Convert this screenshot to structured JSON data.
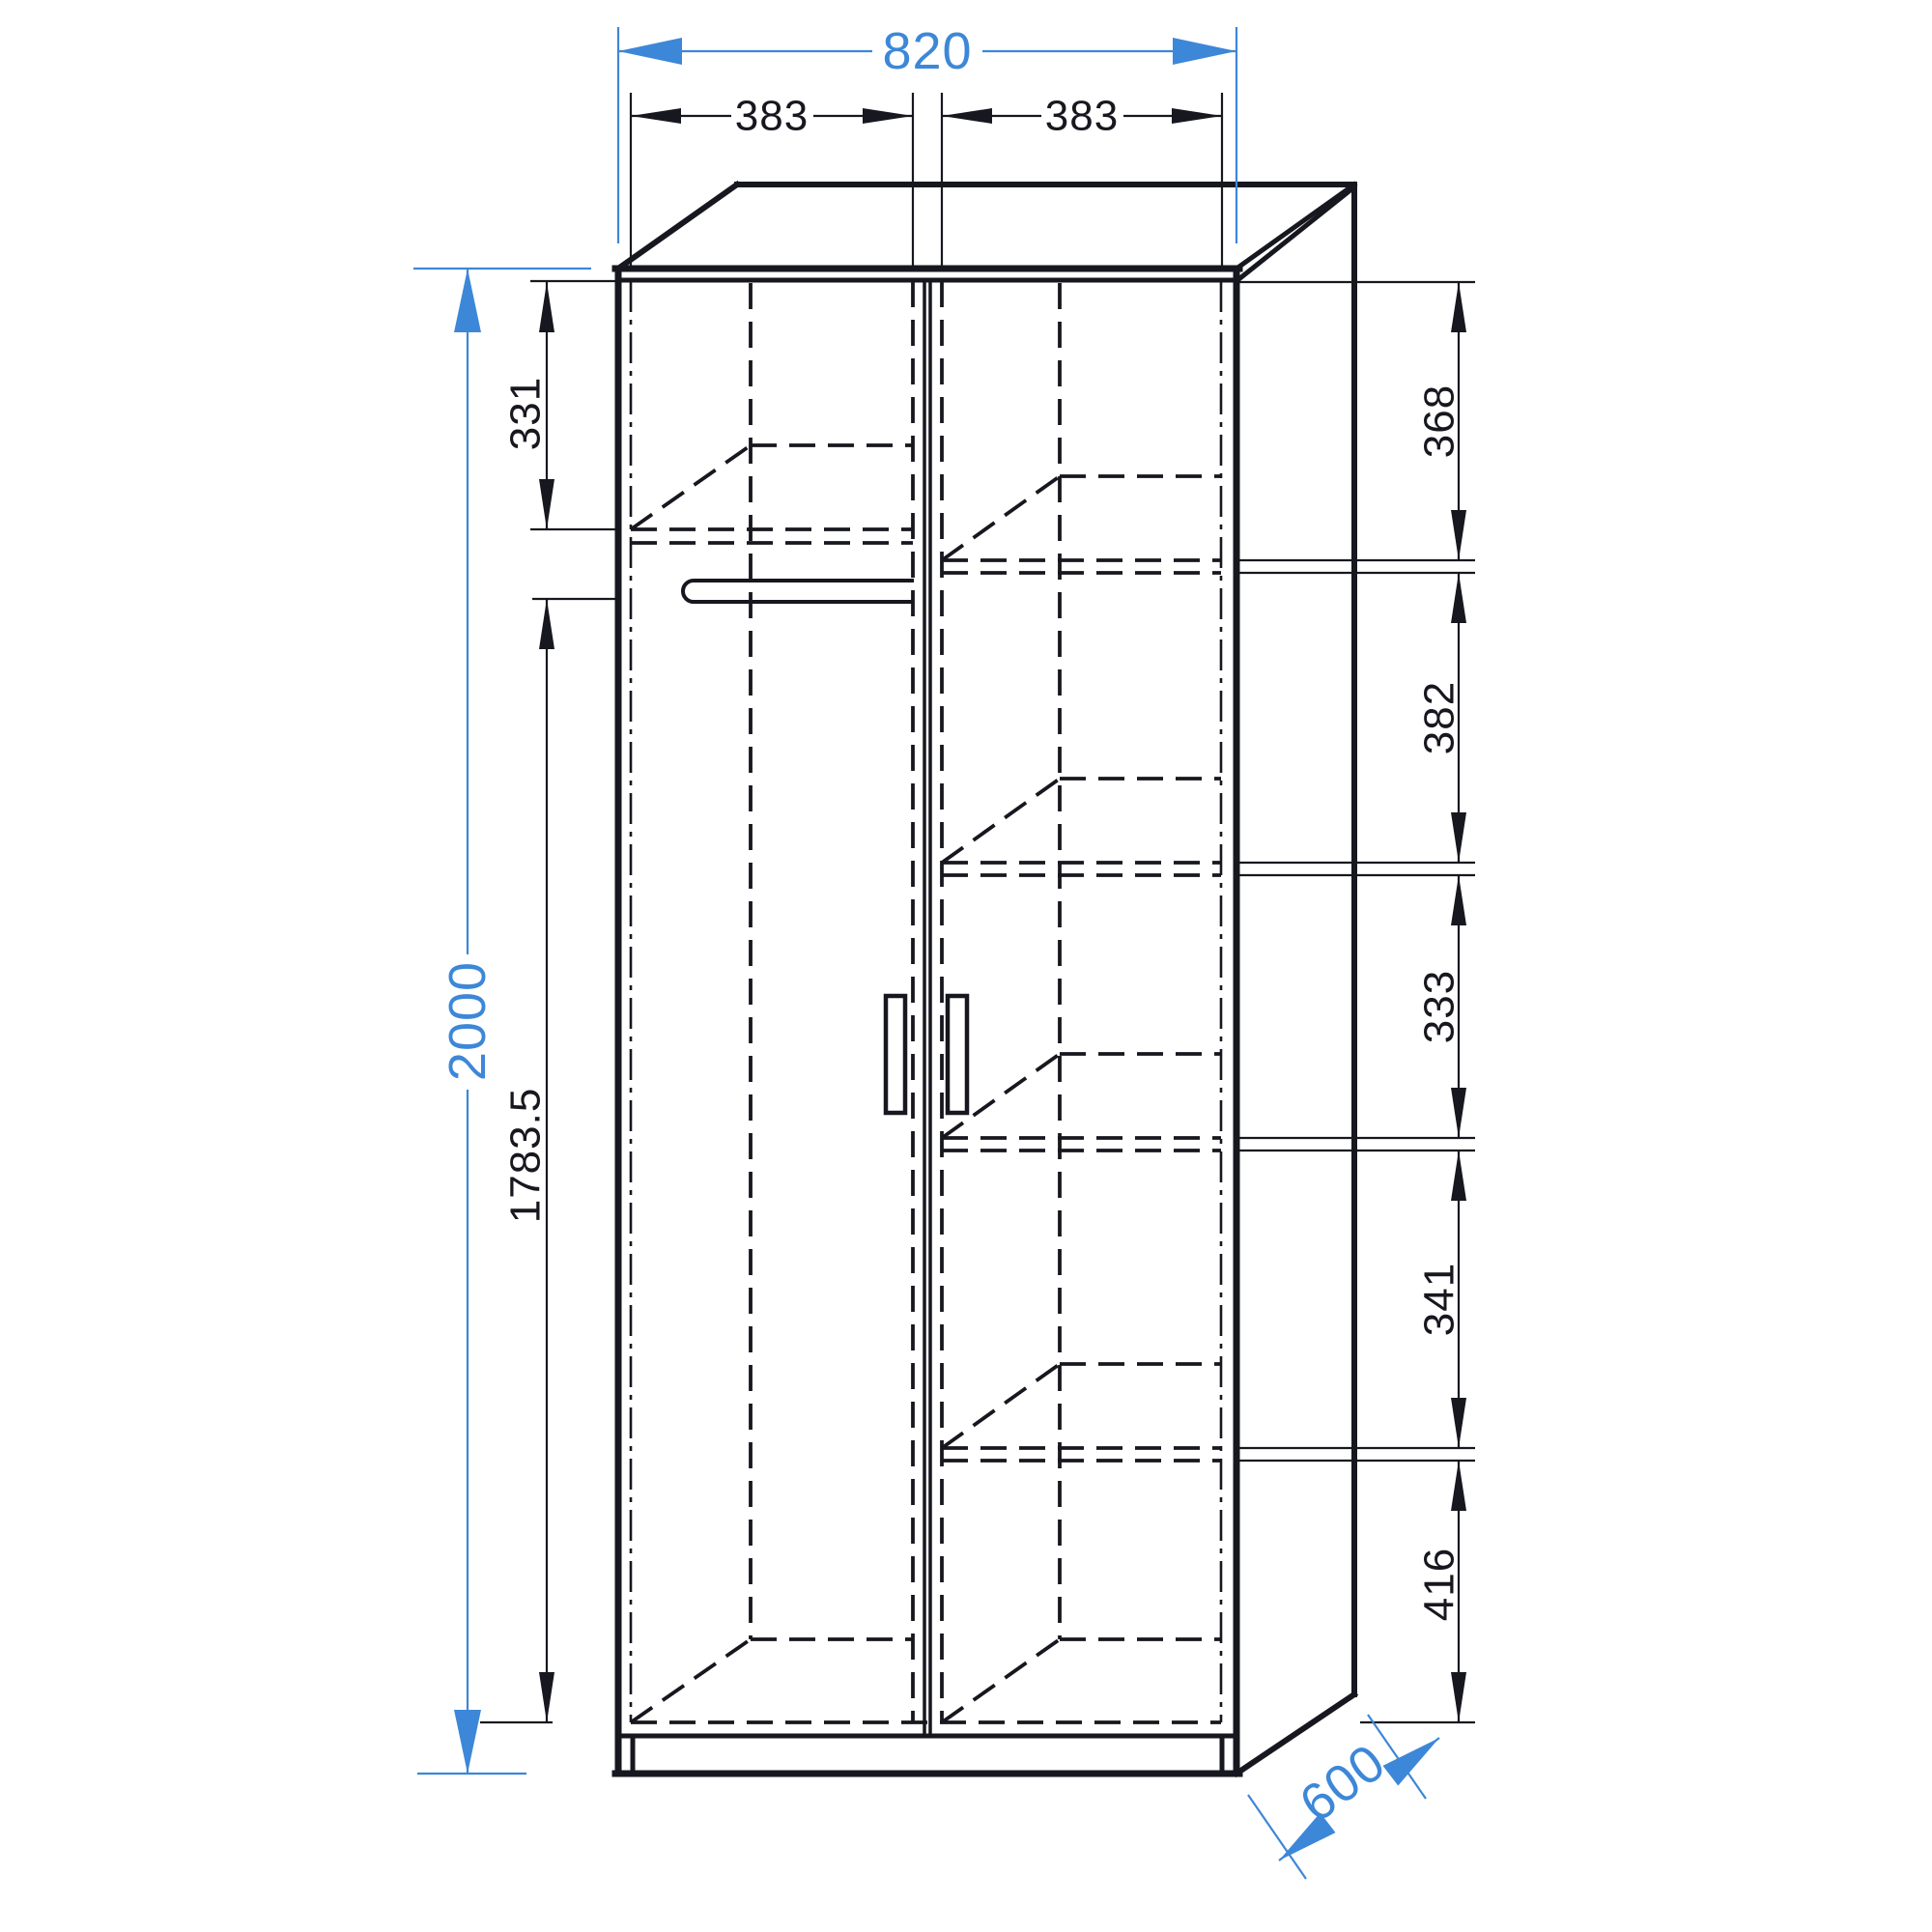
{
  "drawing": {
    "subject": "two-door wardrobe technical drawing, front elevation with perspective depth",
    "view": "front view with right-side and top depth faces",
    "features": [
      "left compartment with top shelf and hanging rod",
      "right compartment with four shelves",
      "two doors with vertical handles",
      "base plinth"
    ]
  },
  "palette": {
    "background": "#ffffff",
    "line": "#17171f",
    "accent": "#3d87d8"
  },
  "dims": {
    "top": {
      "overall_width": "820",
      "left_opening": "383",
      "right_opening": "383"
    },
    "left": {
      "overall_height": "2000",
      "top_section": "331",
      "lower_section": "1783.5"
    },
    "right": {
      "sections": [
        "368",
        "382",
        "333",
        "341",
        "416"
      ]
    },
    "bottom": {
      "depth": "600"
    }
  }
}
